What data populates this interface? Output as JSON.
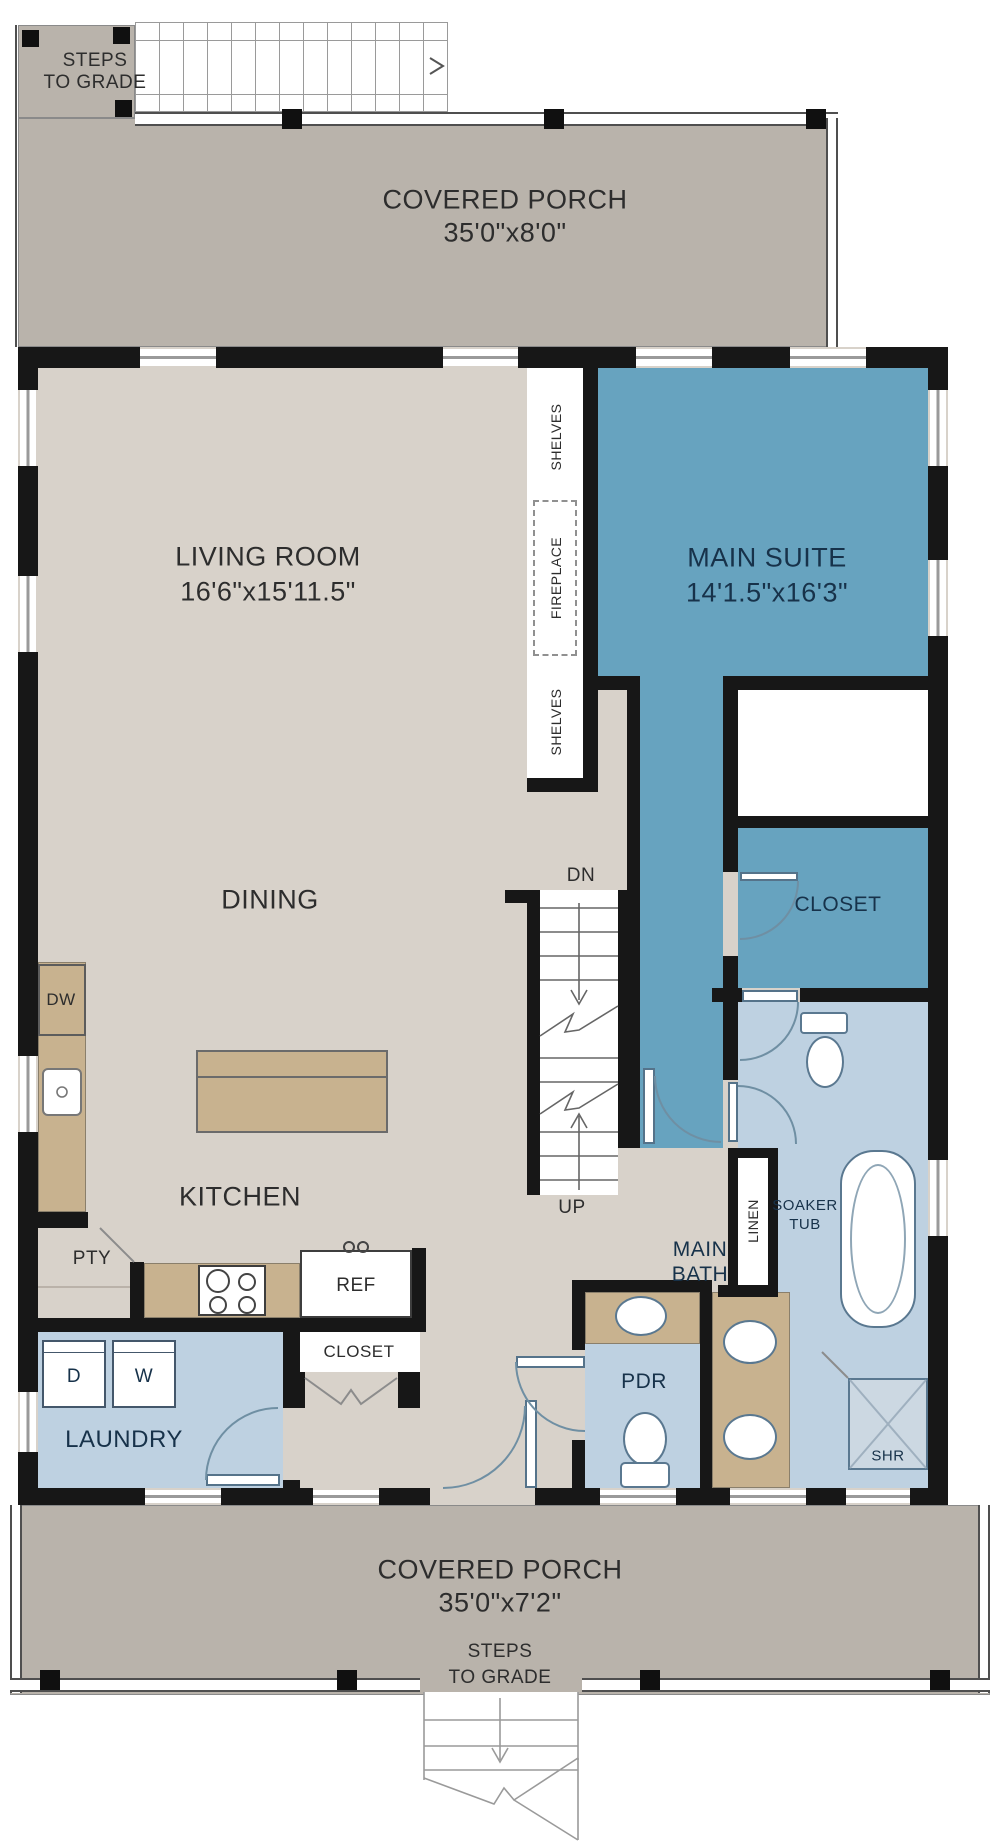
{
  "plan": {
    "porch_top_label": "COVERED PORCH",
    "porch_top_dims": "35'0\"x8'0\"",
    "porch_bottom_label": "COVERED PORCH",
    "porch_bottom_dims": "35'0\"x7'2\"",
    "steps_top_line1": "STEPS",
    "steps_top_line2": "TO GRADE",
    "steps_bottom_line1": "STEPS",
    "steps_bottom_line2": "TO GRADE",
    "living_label": "LIVING ROOM",
    "living_dims": "16'6\"x15'11.5\"",
    "suite_label": "MAIN SUITE",
    "suite_dims": "14'1.5\"x16'3\"",
    "dining_label": "DINING",
    "kitchen_label": "KITCHEN",
    "closet_suite_label": "CLOSET",
    "closet_hall_label": "CLOSET",
    "laundry_label": "LAUNDRY",
    "pdr_label": "PDR",
    "linen_label": "LINEN",
    "pantry_label": "PTY",
    "main_bath_line1": "MAIN",
    "main_bath_line2": "BATH",
    "soaker_line1": "SOAKER",
    "soaker_line2": "TUB",
    "shower_label": "SHR",
    "shelves_top_label": "SHELVES",
    "fireplace_label": "FIREPLACE",
    "shelves_bottom_label": "SHELVES",
    "stairs_down_label": "DN",
    "stairs_up_label": "UP",
    "dishwasher_label": "DW",
    "fridge_label": "REF",
    "dryer_label": "D",
    "washer_label": "W"
  },
  "colors": {
    "porch_gray": "#b9b3ab",
    "floor_beige": "#d8d2ca",
    "suite_blue": "#67a3bf",
    "bath_blue": "#bed1e1",
    "counter_tan": "#c8b28f",
    "wall_black": "#171717",
    "label_dark": "#2d2d2d",
    "label_navy": "#17324a"
  }
}
